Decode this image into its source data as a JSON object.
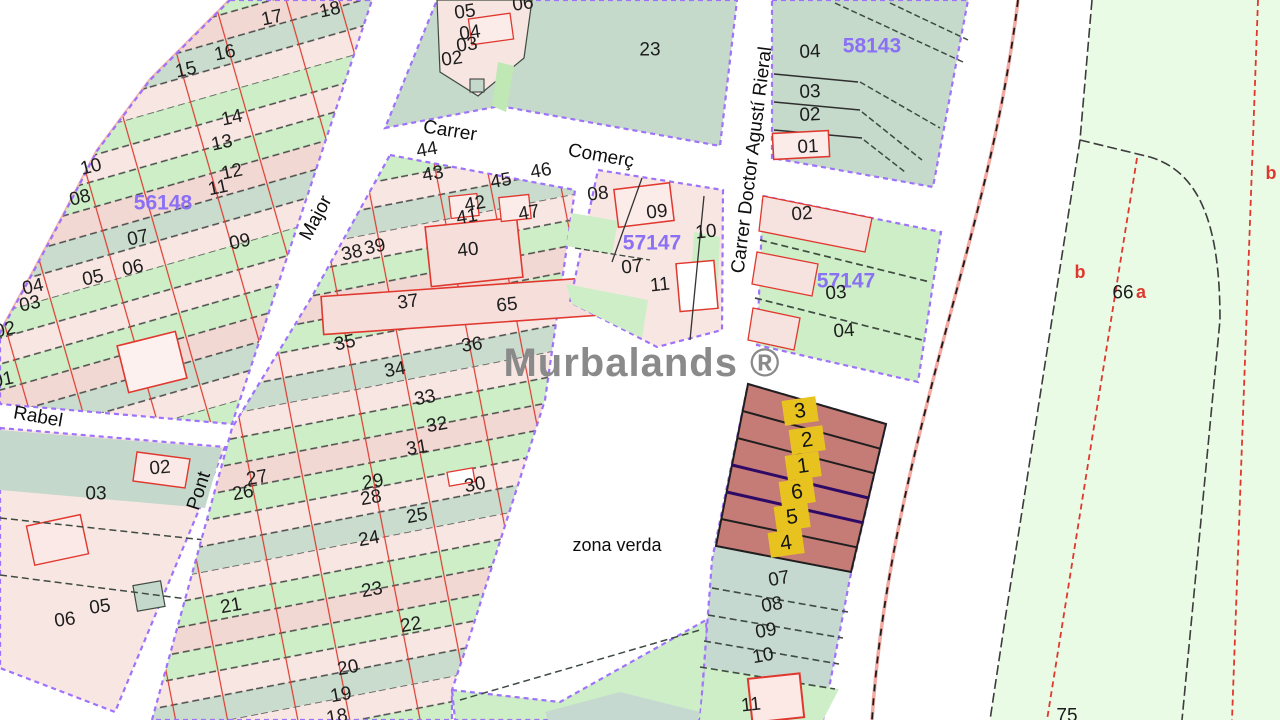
{
  "map": {
    "watermark_text": "Murbalands ®",
    "colors": {
      "block_outline_purple": "#9e72fb",
      "zone_text_purple": "#8a70f5",
      "red_line": "#e0382e",
      "dark_line": "#3f4b42",
      "municipal_boundary_pink": "#f2a9a2",
      "highlight_parcel_fill": "#c57b76",
      "highlight_label_yellow": "#e8c320",
      "parcel_green": "#cdeec6",
      "rural_pale_green": "#e9fae5",
      "parcel_teal": "#c5d9cc",
      "parcel_pink": "#f8e6e2",
      "watermark_gray": "#8a8a8a"
    },
    "labels": [
      {
        "text": "17",
        "x": 272,
        "y": 18,
        "rot": -12,
        "kind": "parcel"
      },
      {
        "text": "18",
        "x": 330,
        "y": 10,
        "rot": -12,
        "kind": "parcel"
      },
      {
        "text": "16",
        "x": 225,
        "y": 53,
        "rot": -12,
        "kind": "parcel"
      },
      {
        "text": "15",
        "x": 186,
        "y": 70,
        "rot": -12,
        "kind": "parcel"
      },
      {
        "text": "14",
        "x": 232,
        "y": 118,
        "rot": -12,
        "kind": "parcel"
      },
      {
        "text": "13",
        "x": 222,
        "y": 143,
        "rot": -12,
        "kind": "parcel"
      },
      {
        "text": "12",
        "x": 232,
        "y": 172,
        "rot": -12,
        "kind": "parcel"
      },
      {
        "text": "11",
        "x": 218,
        "y": 188,
        "rot": -12,
        "kind": "parcel"
      },
      {
        "text": "10",
        "x": 91,
        "y": 167,
        "rot": -14,
        "kind": "parcel"
      },
      {
        "text": "08",
        "x": 80,
        "y": 198,
        "rot": -14,
        "kind": "parcel"
      },
      {
        "text": "56148",
        "x": 163,
        "y": 203,
        "rot": 0,
        "kind": "zone"
      },
      {
        "text": "09",
        "x": 240,
        "y": 242,
        "rot": -12,
        "kind": "parcel"
      },
      {
        "text": "07",
        "x": 138,
        "y": 238,
        "rot": -12,
        "kind": "parcel"
      },
      {
        "text": "06",
        "x": 133,
        "y": 268,
        "rot": -12,
        "kind": "parcel"
      },
      {
        "text": "05",
        "x": 93,
        "y": 278,
        "rot": -12,
        "kind": "parcel"
      },
      {
        "text": "04",
        "x": 33,
        "y": 287,
        "rot": -12,
        "kind": "parcel"
      },
      {
        "text": "03",
        "x": 30,
        "y": 304,
        "rot": -12,
        "kind": "parcel"
      },
      {
        "text": "02",
        "x": 5,
        "y": 330,
        "rot": -12,
        "kind": "parcel"
      },
      {
        "text": "01",
        "x": 3,
        "y": 380,
        "rot": -12,
        "kind": "parcel"
      },
      {
        "text": "05",
        "x": 465,
        "y": 12,
        "rot": -8,
        "kind": "parcel"
      },
      {
        "text": "06",
        "x": 523,
        "y": 4,
        "rot": -8,
        "kind": "parcel"
      },
      {
        "text": "04",
        "x": 470,
        "y": 33,
        "rot": -8,
        "kind": "parcel"
      },
      {
        "text": "03",
        "x": 467,
        "y": 45,
        "rot": -8,
        "kind": "parcel"
      },
      {
        "text": "02",
        "x": 452,
        "y": 59,
        "rot": -8,
        "kind": "parcel"
      },
      {
        "text": "23",
        "x": 650,
        "y": 50,
        "rot": 0,
        "kind": "parcel"
      },
      {
        "text": "Carrer",
        "x": 450,
        "y": 131,
        "rot": 9,
        "kind": "street"
      },
      {
        "text": "Comerç",
        "x": 601,
        "y": 156,
        "rot": 10,
        "kind": "street"
      },
      {
        "text": "Carrer Doctor Agustí Rieral",
        "x": 752,
        "y": 160,
        "rot": -83,
        "kind": "street"
      },
      {
        "text": "Major",
        "x": 316,
        "y": 218,
        "rot": -62,
        "kind": "street"
      },
      {
        "text": "Pont",
        "x": 199,
        "y": 491,
        "rot": -72,
        "kind": "street"
      },
      {
        "text": "Rabel",
        "x": 38,
        "y": 417,
        "rot": 10,
        "kind": "street"
      },
      {
        "text": "04",
        "x": 810,
        "y": 52,
        "rot": -3,
        "kind": "parcel"
      },
      {
        "text": "58143",
        "x": 872,
        "y": 46,
        "rot": 0,
        "kind": "zone"
      },
      {
        "text": "03",
        "x": 810,
        "y": 92,
        "rot": -3,
        "kind": "parcel"
      },
      {
        "text": "02",
        "x": 810,
        "y": 115,
        "rot": -3,
        "kind": "parcel"
      },
      {
        "text": "01",
        "x": 808,
        "y": 147,
        "rot": -3,
        "kind": "parcel"
      },
      {
        "text": "08",
        "x": 598,
        "y": 194,
        "rot": -6,
        "kind": "parcel"
      },
      {
        "text": "09",
        "x": 657,
        "y": 212,
        "rot": -6,
        "kind": "parcel"
      },
      {
        "text": "10",
        "x": 706,
        "y": 232,
        "rot": -6,
        "kind": "parcel"
      },
      {
        "text": "57147",
        "x": 652,
        "y": 243,
        "rot": 0,
        "kind": "zone"
      },
      {
        "text": "07",
        "x": 632,
        "y": 267,
        "rot": -6,
        "kind": "parcel"
      },
      {
        "text": "11",
        "x": 660,
        "y": 285,
        "rot": -6,
        "kind": "parcel"
      },
      {
        "text": "02",
        "x": 802,
        "y": 214,
        "rot": -4,
        "kind": "parcel"
      },
      {
        "text": "57147",
        "x": 846,
        "y": 281,
        "rot": 0,
        "kind": "zone"
      },
      {
        "text": "03",
        "x": 836,
        "y": 293,
        "rot": -4,
        "kind": "parcel"
      },
      {
        "text": "04",
        "x": 844,
        "y": 331,
        "rot": -4,
        "kind": "parcel"
      },
      {
        "text": "44",
        "x": 427,
        "y": 150,
        "rot": -10,
        "kind": "parcel"
      },
      {
        "text": "43",
        "x": 433,
        "y": 174,
        "rot": -10,
        "kind": "parcel"
      },
      {
        "text": "46",
        "x": 541,
        "y": 171,
        "rot": -10,
        "kind": "parcel"
      },
      {
        "text": "45",
        "x": 501,
        "y": 181,
        "rot": -10,
        "kind": "parcel"
      },
      {
        "text": "42",
        "x": 475,
        "y": 204,
        "rot": -10,
        "kind": "parcel"
      },
      {
        "text": "41",
        "x": 467,
        "y": 217,
        "rot": -10,
        "kind": "parcel"
      },
      {
        "text": "47",
        "x": 529,
        "y": 213,
        "rot": -10,
        "kind": "parcel"
      },
      {
        "text": "40",
        "x": 468,
        "y": 250,
        "rot": -6,
        "kind": "parcel"
      },
      {
        "text": "39",
        "x": 375,
        "y": 247,
        "rot": -12,
        "kind": "parcel"
      },
      {
        "text": "38",
        "x": 352,
        "y": 253,
        "rot": -12,
        "kind": "parcel"
      },
      {
        "text": "37",
        "x": 408,
        "y": 302,
        "rot": -8,
        "kind": "parcel"
      },
      {
        "text": "65",
        "x": 507,
        "y": 305,
        "rot": -6,
        "kind": "parcel"
      },
      {
        "text": "35",
        "x": 345,
        "y": 343,
        "rot": -12,
        "kind": "parcel"
      },
      {
        "text": "36",
        "x": 472,
        "y": 345,
        "rot": -8,
        "kind": "parcel"
      },
      {
        "text": "34",
        "x": 395,
        "y": 370,
        "rot": -10,
        "kind": "parcel"
      },
      {
        "text": "33",
        "x": 425,
        "y": 398,
        "rot": -10,
        "kind": "parcel"
      },
      {
        "text": "32",
        "x": 437,
        "y": 425,
        "rot": -10,
        "kind": "parcel"
      },
      {
        "text": "31",
        "x": 417,
        "y": 448,
        "rot": -10,
        "kind": "parcel"
      },
      {
        "text": "30",
        "x": 475,
        "y": 485,
        "rot": -10,
        "kind": "parcel"
      },
      {
        "text": "29",
        "x": 373,
        "y": 482,
        "rot": -10,
        "kind": "parcel"
      },
      {
        "text": "28",
        "x": 371,
        "y": 498,
        "rot": -10,
        "kind": "parcel"
      },
      {
        "text": "27",
        "x": 257,
        "y": 478,
        "rot": -10,
        "kind": "parcel"
      },
      {
        "text": "26",
        "x": 243,
        "y": 493,
        "rot": -10,
        "kind": "parcel"
      },
      {
        "text": "25",
        "x": 417,
        "y": 516,
        "rot": -10,
        "kind": "parcel"
      },
      {
        "text": "24",
        "x": 369,
        "y": 539,
        "rot": -10,
        "kind": "parcel"
      },
      {
        "text": "23",
        "x": 372,
        "y": 590,
        "rot": -10,
        "kind": "parcel"
      },
      {
        "text": "22",
        "x": 411,
        "y": 625,
        "rot": -10,
        "kind": "parcel"
      },
      {
        "text": "21",
        "x": 231,
        "y": 606,
        "rot": -10,
        "kind": "parcel"
      },
      {
        "text": "20",
        "x": 348,
        "y": 668,
        "rot": -10,
        "kind": "parcel"
      },
      {
        "text": "19",
        "x": 341,
        "y": 695,
        "rot": -10,
        "kind": "parcel"
      },
      {
        "text": "18",
        "x": 337,
        "y": 717,
        "rot": -10,
        "kind": "parcel"
      },
      {
        "text": "02",
        "x": 160,
        "y": 468,
        "rot": -5,
        "kind": "parcel"
      },
      {
        "text": "03",
        "x": 96,
        "y": 494,
        "rot": 0,
        "kind": "parcel"
      },
      {
        "text": "05",
        "x": 100,
        "y": 607,
        "rot": -8,
        "kind": "parcel"
      },
      {
        "text": "06",
        "x": 65,
        "y": 620,
        "rot": -8,
        "kind": "parcel"
      },
      {
        "text": "Murbalands ®",
        "x": 642,
        "y": 363,
        "rot": 0,
        "kind": "watermark"
      },
      {
        "text": "zona verda",
        "x": 617,
        "y": 545,
        "rot": 0,
        "kind": "area"
      },
      {
        "text": "3",
        "x": 800,
        "y": 411,
        "rot": -8,
        "kind": "highlight"
      },
      {
        "text": "2",
        "x": 807,
        "y": 440,
        "rot": -8,
        "kind": "highlight"
      },
      {
        "text": "1",
        "x": 803,
        "y": 466,
        "rot": -8,
        "kind": "highlight"
      },
      {
        "text": "6",
        "x": 797,
        "y": 492,
        "rot": -8,
        "kind": "highlight"
      },
      {
        "text": "5",
        "x": 792,
        "y": 517,
        "rot": -8,
        "kind": "highlight"
      },
      {
        "text": "4",
        "x": 786,
        "y": 543,
        "rot": -8,
        "kind": "highlight"
      },
      {
        "text": "07",
        "x": 779,
        "y": 579,
        "rot": -10,
        "kind": "parcel"
      },
      {
        "text": "08",
        "x": 772,
        "y": 605,
        "rot": -10,
        "kind": "parcel"
      },
      {
        "text": "09",
        "x": 766,
        "y": 631,
        "rot": -10,
        "kind": "parcel"
      },
      {
        "text": "10",
        "x": 763,
        "y": 656,
        "rot": -10,
        "kind": "parcel"
      },
      {
        "text": "11",
        "x": 751,
        "y": 705,
        "rot": -6,
        "kind": "parcel"
      },
      {
        "text": "b",
        "x": 1080,
        "y": 272,
        "rot": 0,
        "kind": "red"
      },
      {
        "text": "66",
        "x": 1123,
        "y": 293,
        "rot": 0,
        "kind": "parcel"
      },
      {
        "text": "a",
        "x": 1141,
        "y": 292,
        "rot": 0,
        "kind": "red"
      },
      {
        "text": "b",
        "x": 1271,
        "y": 173,
        "rot": 0,
        "kind": "red"
      },
      {
        "text": "75",
        "x": 1067,
        "y": 716,
        "rot": 0,
        "kind": "parcel"
      }
    ]
  }
}
